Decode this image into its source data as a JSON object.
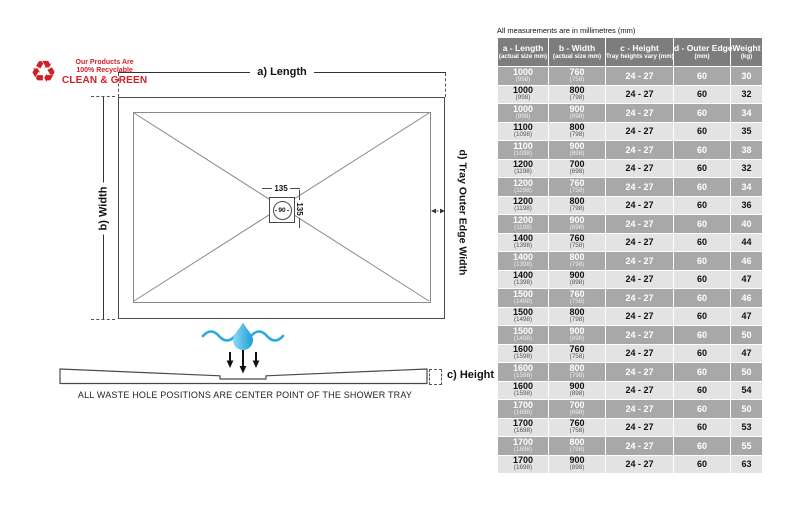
{
  "diagram": {
    "eco_badge": {
      "line1": "Our Products Are",
      "line2": "100% Recyclable",
      "line3": "CLEAN & GREEN"
    },
    "labels": {
      "length": "a) Length",
      "width": "b) Width",
      "height": "c) Height",
      "outer_edge": "d) Tray Outer Edge Width"
    },
    "waste_hole": {
      "dim_top": "135",
      "dim_side": "135",
      "diameter": "90"
    },
    "caption": "ALL WASTE HOLE POSITIONS ARE CENTER POINT OF THE SHOWER TRAY"
  },
  "colors": {
    "accent_red": "#d11f26",
    "water_blue": "#29a9e0",
    "header_gray": "#7d7d7d",
    "row_dark": "#a8a8a8",
    "row_light": "#e3e3e3"
  },
  "table": {
    "note": "All measurements are in millimetres (mm)",
    "headers": [
      {
        "main": "a - Length",
        "sub": "(actual size mm)"
      },
      {
        "main": "b - Width",
        "sub": "(actual size mm)"
      },
      {
        "main": "c - Height",
        "sub": "Tray heights vary (mm)"
      },
      {
        "main": "d - Outer Edge",
        "sub": "(mm)"
      },
      {
        "main": "Weight",
        "sub": "(kg)"
      }
    ],
    "rows": [
      {
        "length": "1000",
        "length_actual": "(998)",
        "width": "760",
        "width_actual": "(758)",
        "height": "24 - 27",
        "outer_edge": "60",
        "weight": "30"
      },
      {
        "length": "1000",
        "length_actual": "(998)",
        "width": "800",
        "width_actual": "(798)",
        "height": "24 - 27",
        "outer_edge": "60",
        "weight": "32"
      },
      {
        "length": "1000",
        "length_actual": "(998)",
        "width": "900",
        "width_actual": "(898)",
        "height": "24 - 27",
        "outer_edge": "60",
        "weight": "34"
      },
      {
        "length": "1100",
        "length_actual": "(1098)",
        "width": "800",
        "width_actual": "(798)",
        "height": "24 - 27",
        "outer_edge": "60",
        "weight": "35"
      },
      {
        "length": "1100",
        "length_actual": "(1098)",
        "width": "900",
        "width_actual": "(898)",
        "height": "24 - 27",
        "outer_edge": "60",
        "weight": "38"
      },
      {
        "length": "1200",
        "length_actual": "(1198)",
        "width": "700",
        "width_actual": "(698)",
        "height": "24 - 27",
        "outer_edge": "60",
        "weight": "32"
      },
      {
        "length": "1200",
        "length_actual": "(1198)",
        "width": "760",
        "width_actual": "(758)",
        "height": "24 - 27",
        "outer_edge": "60",
        "weight": "34"
      },
      {
        "length": "1200",
        "length_actual": "(1198)",
        "width": "800",
        "width_actual": "(798)",
        "height": "24 - 27",
        "outer_edge": "60",
        "weight": "36"
      },
      {
        "length": "1200",
        "length_actual": "(1198)",
        "width": "900",
        "width_actual": "(898)",
        "height": "24 - 27",
        "outer_edge": "60",
        "weight": "40"
      },
      {
        "length": "1400",
        "length_actual": "(1398)",
        "width": "760",
        "width_actual": "(758)",
        "height": "24 - 27",
        "outer_edge": "60",
        "weight": "44"
      },
      {
        "length": "1400",
        "length_actual": "(1398)",
        "width": "800",
        "width_actual": "(798)",
        "height": "24 - 27",
        "outer_edge": "60",
        "weight": "46"
      },
      {
        "length": "1400",
        "length_actual": "(1398)",
        "width": "900",
        "width_actual": "(898)",
        "height": "24 - 27",
        "outer_edge": "60",
        "weight": "47"
      },
      {
        "length": "1500",
        "length_actual": "(1498)",
        "width": "760",
        "width_actual": "(758)",
        "height": "24 - 27",
        "outer_edge": "60",
        "weight": "46"
      },
      {
        "length": "1500",
        "length_actual": "(1498)",
        "width": "800",
        "width_actual": "(798)",
        "height": "24 - 27",
        "outer_edge": "60",
        "weight": "47"
      },
      {
        "length": "1500",
        "length_actual": "(1498)",
        "width": "900",
        "width_actual": "(898)",
        "height": "24 - 27",
        "outer_edge": "60",
        "weight": "50"
      },
      {
        "length": "1600",
        "length_actual": "(1598)",
        "width": "760",
        "width_actual": "(758)",
        "height": "24 - 27",
        "outer_edge": "60",
        "weight": "47"
      },
      {
        "length": "1600",
        "length_actual": "(1598)",
        "width": "800",
        "width_actual": "(798)",
        "height": "24 - 27",
        "outer_edge": "60",
        "weight": "50"
      },
      {
        "length": "1600",
        "length_actual": "(1598)",
        "width": "900",
        "width_actual": "(898)",
        "height": "24 - 27",
        "outer_edge": "60",
        "weight": "54"
      },
      {
        "length": "1700",
        "length_actual": "(1698)",
        "width": "700",
        "width_actual": "(698)",
        "height": "24 - 27",
        "outer_edge": "60",
        "weight": "50"
      },
      {
        "length": "1700",
        "length_actual": "(1698)",
        "width": "760",
        "width_actual": "(758)",
        "height": "24 - 27",
        "outer_edge": "60",
        "weight": "53"
      },
      {
        "length": "1700",
        "length_actual": "(1698)",
        "width": "800",
        "width_actual": "(798)",
        "height": "24 - 27",
        "outer_edge": "60",
        "weight": "55"
      },
      {
        "length": "1700",
        "length_actual": "(1698)",
        "width": "900",
        "width_actual": "(898)",
        "height": "24 - 27",
        "outer_edge": "60",
        "weight": "63"
      }
    ]
  }
}
